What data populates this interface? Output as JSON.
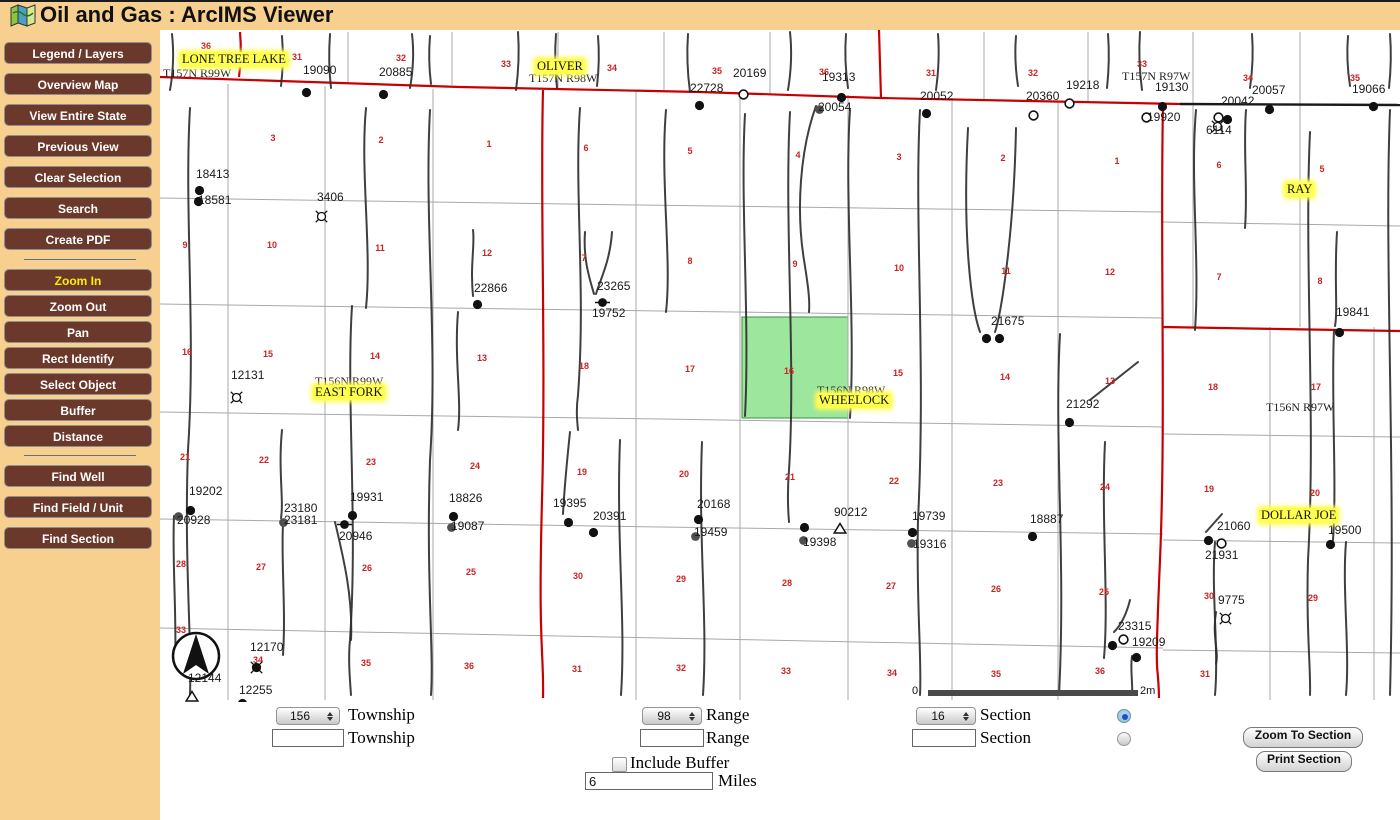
{
  "header": {
    "title": "Oil and Gas : ArcIMS Viewer"
  },
  "colors": {
    "header_bg": "#F7CF8E",
    "button_bg": "#6B392C",
    "button_text": "#FFFFFF",
    "active_tool_color": "#FFEB00",
    "boundary_red": "#C80000",
    "black_line": "#1A1A1A",
    "grid_gray": "#A8A8A8",
    "selected_section_green": "#9DE69D",
    "highlight_yellow": "#FFFF4F",
    "section_number_red": "#CC2222"
  },
  "sidebar": {
    "groups": [
      {
        "buttons": [
          {
            "label": "Legend / Layers"
          },
          {
            "label": "Overview Map"
          },
          {
            "label": "View Entire State"
          },
          {
            "label": "Previous View"
          },
          {
            "label": "Clear Selection"
          },
          {
            "label": "Search"
          },
          {
            "label": "Create PDF"
          }
        ]
      },
      {
        "buttons": [
          {
            "label": "Zoom In",
            "active": true
          },
          {
            "label": "Zoom Out"
          },
          {
            "label": "Pan"
          },
          {
            "label": "Rect Identify"
          },
          {
            "label": "Select Object"
          },
          {
            "label": "Buffer"
          },
          {
            "label": "Distance"
          }
        ]
      },
      {
        "buttons": [
          {
            "label": "Find Well"
          },
          {
            "label": "Find Field / Unit"
          },
          {
            "label": "Find Section"
          }
        ]
      }
    ]
  },
  "map": {
    "field_labels": [
      {
        "text": "LONE TREE LAKE",
        "x": 180,
        "y": 52
      },
      {
        "text": "OLIVER",
        "x": 535,
        "y": 59
      },
      {
        "text": "RAY",
        "x": 1285,
        "y": 182
      },
      {
        "text": "EAST FORK",
        "x": 313,
        "y": 385
      },
      {
        "text": "WHEELOCK",
        "x": 817,
        "y": 393
      },
      {
        "text": "DOLLAR JOE",
        "x": 1259,
        "y": 508
      }
    ],
    "township_labels": [
      {
        "text": "T157N R99W",
        "x": 163,
        "y": 66
      },
      {
        "text": "T157N R98W",
        "x": 529,
        "y": 71
      },
      {
        "text": "T157N R97W",
        "x": 1122,
        "y": 69
      },
      {
        "text": "T156N R99W",
        "x": 315,
        "y": 374
      },
      {
        "text": "T156N R98W",
        "x": 817,
        "y": 383
      },
      {
        "text": "T156N R97W",
        "x": 1266,
        "y": 400
      }
    ],
    "section_numbers": [
      [
        "36",
        206,
        46
      ],
      [
        "31",
        297,
        57
      ],
      [
        "32",
        401,
        58
      ],
      [
        "33",
        506,
        64
      ],
      [
        "34",
        612,
        68
      ],
      [
        "35",
        717,
        71
      ],
      [
        "36",
        824,
        72
      ],
      [
        "31",
        931,
        73
      ],
      [
        "32",
        1033,
        73
      ],
      [
        "33",
        1142,
        64
      ],
      [
        "34",
        1248,
        78
      ],
      [
        "35",
        1355,
        78
      ],
      [
        "3",
        273,
        138
      ],
      [
        "2",
        381,
        140
      ],
      [
        "1",
        489,
        144
      ],
      [
        "6",
        586,
        148
      ],
      [
        "5",
        690,
        151
      ],
      [
        "4",
        798,
        155
      ],
      [
        "3",
        899,
        157
      ],
      [
        "2",
        1003,
        158
      ],
      [
        "1",
        1117,
        161
      ],
      [
        "6",
        1219,
        165
      ],
      [
        "5",
        1322,
        169
      ],
      [
        "9",
        185,
        245
      ],
      [
        "10",
        272,
        245
      ],
      [
        "11",
        380,
        248
      ],
      [
        "12",
        487,
        253
      ],
      [
        "7",
        584,
        258
      ],
      [
        "8",
        690,
        261
      ],
      [
        "9",
        795,
        264
      ],
      [
        "10",
        899,
        268
      ],
      [
        "11",
        1006,
        271
      ],
      [
        "12",
        1110,
        272
      ],
      [
        "7",
        1219,
        277
      ],
      [
        "8",
        1320,
        281
      ],
      [
        "16",
        187,
        352
      ],
      [
        "15",
        268,
        354
      ],
      [
        "14",
        375,
        356
      ],
      [
        "13",
        482,
        358
      ],
      [
        "18",
        584,
        366
      ],
      [
        "17",
        690,
        369
      ],
      [
        "16",
        789,
        371
      ],
      [
        "15",
        898,
        373
      ],
      [
        "14",
        1005,
        377
      ],
      [
        "13",
        1110,
        381
      ],
      [
        "18",
        1213,
        387
      ],
      [
        "17",
        1316,
        387
      ],
      [
        "21",
        185,
        457
      ],
      [
        "22",
        264,
        460
      ],
      [
        "23",
        371,
        462
      ],
      [
        "24",
        475,
        466
      ],
      [
        "19",
        582,
        472
      ],
      [
        "20",
        684,
        474
      ],
      [
        "21",
        790,
        477
      ],
      [
        "22",
        894,
        481
      ],
      [
        "23",
        998,
        483
      ],
      [
        "24",
        1105,
        487
      ],
      [
        "19",
        1209,
        489
      ],
      [
        "20",
        1315,
        493
      ],
      [
        "28",
        181,
        564
      ],
      [
        "27",
        261,
        567
      ],
      [
        "26",
        367,
        568
      ],
      [
        "25",
        471,
        572
      ],
      [
        "30",
        578,
        576
      ],
      [
        "29",
        681,
        579
      ],
      [
        "28",
        787,
        583
      ],
      [
        "27",
        891,
        586
      ],
      [
        "26",
        996,
        589
      ],
      [
        "25",
        1104,
        592
      ],
      [
        "30",
        1209,
        596
      ],
      [
        "29",
        1313,
        598
      ],
      [
        "33",
        181,
        630
      ],
      [
        "34",
        258,
        660
      ],
      [
        "35",
        366,
        663
      ],
      [
        "36",
        469,
        666
      ],
      [
        "31",
        577,
        669
      ],
      [
        "32",
        681,
        668
      ],
      [
        "33",
        786,
        671
      ],
      [
        "34",
        892,
        673
      ],
      [
        "35",
        996,
        674
      ],
      [
        "36",
        1100,
        671
      ],
      [
        "31",
        1205,
        674
      ]
    ],
    "wells": [
      {
        "label": "19090",
        "lx": 303,
        "ly": 63,
        "sym": "dot",
        "sx": 301,
        "sy": 87
      },
      {
        "label": "20885",
        "lx": 379,
        "ly": 65,
        "sym": "dot",
        "sx": 378,
        "sy": 89
      },
      {
        "label": "20169",
        "lx": 733,
        "ly": 66,
        "sym": "none"
      },
      {
        "label": "22728",
        "lx": 690,
        "ly": 81,
        "sym": "open",
        "sx": 737,
        "sy": 88,
        "sym2": "dot",
        "s2x": 694,
        "s2y": 100
      },
      {
        "label": "19313",
        "lx": 822,
        "ly": 70,
        "sym": "dot",
        "sx": 836,
        "sy": 92
      },
      {
        "label": "20054",
        "lx": 818,
        "ly": 100,
        "sym": "graydot",
        "sx": 814,
        "sy": 104
      },
      {
        "label": "20052",
        "lx": 920,
        "ly": 89,
        "sym": "dot",
        "sx": 921,
        "sy": 108
      },
      {
        "label": "20360",
        "lx": 1026,
        "ly": 89,
        "sym": "open",
        "sx": 1063,
        "sy": 97,
        "sym2": "open",
        "s2x": 1027,
        "s2y": 109
      },
      {
        "label": "19218",
        "lx": 1066,
        "ly": 78,
        "sym": "none"
      },
      {
        "label": "19130",
        "lx": 1155,
        "ly": 80,
        "sym": "dot",
        "sx": 1157,
        "sy": 101
      },
      {
        "label": "19920",
        "lx": 1147,
        "ly": 110,
        "sym": "open",
        "sx": 1140,
        "sy": 111
      },
      {
        "label": "20042",
        "lx": 1221,
        "ly": 94,
        "sym": "open",
        "sx": 1212,
        "sy": 111,
        "sym2": "dot",
        "s2x": 1222,
        "s2y": 114
      },
      {
        "label": "6114",
        "lx": 1206,
        "ly": 123,
        "sym": "dryhole",
        "sx": 1208,
        "sy": 117
      },
      {
        "label": "20057",
        "lx": 1252,
        "ly": 83,
        "sym": "dot",
        "sx": 1264,
        "sy": 104
      },
      {
        "label": "19066",
        "lx": 1352,
        "ly": 82,
        "sym": "dot",
        "sx": 1368,
        "sy": 101
      },
      {
        "label": "18413",
        "lx": 196,
        "ly": 167,
        "sym": "dot",
        "sx": 194,
        "sy": 185
      },
      {
        "label": "18581",
        "lx": 198,
        "ly": 193,
        "sym": "dot",
        "sx": 193,
        "sy": 196
      },
      {
        "label": "3406",
        "lx": 317,
        "ly": 190,
        "sym": "dryhole",
        "sx": 312,
        "sy": 207
      },
      {
        "label": "22866",
        "lx": 474,
        "ly": 281,
        "sym": "dot",
        "sx": 472,
        "sy": 299
      },
      {
        "label": "23265",
        "lx": 597,
        "ly": 279,
        "sym": "dotbar",
        "sx": 594,
        "sy": 297
      },
      {
        "label": "19752",
        "lx": 592,
        "ly": 306,
        "sym": "none"
      },
      {
        "label": "21675",
        "lx": 991,
        "ly": 314,
        "sym": "dot",
        "sx": 981,
        "sy": 333,
        "sym2": "dot",
        "s2x": 994,
        "s2y": 333
      },
      {
        "label": "19841",
        "lx": 1336,
        "ly": 305,
        "sym": "dot",
        "sx": 1334,
        "sy": 327
      },
      {
        "label": "12131",
        "lx": 231,
        "ly": 368,
        "sym": "dryhole",
        "sx": 227,
        "sy": 388
      },
      {
        "label": "21292",
        "lx": 1066,
        "ly": 397,
        "sym": "dot",
        "sx": 1064,
        "sy": 417
      },
      {
        "label": "19202",
        "lx": 189,
        "ly": 484,
        "sym": "dot",
        "sx": 185,
        "sy": 505
      },
      {
        "label": "20928",
        "lx": 177,
        "ly": 513,
        "sym": "graydot",
        "sx": 173,
        "sy": 511
      },
      {
        "label": "23180",
        "lx": 284,
        "ly": 501,
        "sym": "none"
      },
      {
        "label": "23181",
        "lx": 284,
        "ly": 513,
        "sym": "graydot",
        "sx": 278,
        "sy": 517
      },
      {
        "label": "19931",
        "lx": 350,
        "ly": 490,
        "sym": "dot",
        "sx": 347,
        "sy": 510
      },
      {
        "label": "20946",
        "lx": 339,
        "ly": 529,
        "sym": "dotbar",
        "sx": 336,
        "sy": 519
      },
      {
        "label": "18826",
        "lx": 449,
        "ly": 491,
        "sym": "dot",
        "sx": 448,
        "sy": 511
      },
      {
        "label": "19087",
        "lx": 451,
        "ly": 519,
        "sym": "graydot",
        "sx": 446,
        "sy": 522
      },
      {
        "label": "19395",
        "lx": 553,
        "ly": 496,
        "sym": "dot",
        "sx": 563,
        "sy": 517
      },
      {
        "label": "20391",
        "lx": 593,
        "ly": 509,
        "sym": "dot",
        "sx": 588,
        "sy": 527
      },
      {
        "label": "20168",
        "lx": 697,
        "ly": 497,
        "sym": "dot",
        "sx": 693,
        "sy": 514
      },
      {
        "label": "19459",
        "lx": 694,
        "ly": 525,
        "sym": "graydot",
        "sx": 690,
        "sy": 531
      },
      {
        "label": "19398",
        "lx": 803,
        "ly": 535,
        "sym": "dot",
        "sx": 799,
        "sy": 522,
        "sym2": "graydot",
        "s2x": 798,
        "s2y": 535
      },
      {
        "label": "90212",
        "lx": 834,
        "ly": 505,
        "sym": "triangle",
        "sx": 833,
        "sy": 522
      },
      {
        "label": "19739",
        "lx": 912,
        "ly": 509,
        "sym": "dot",
        "sx": 907,
        "sy": 527
      },
      {
        "label": "19316",
        "lx": 913,
        "ly": 537,
        "sym": "graydot",
        "sx": 906,
        "sy": 538
      },
      {
        "label": "18887",
        "lx": 1030,
        "ly": 512,
        "sym": "dot",
        "sx": 1027,
        "sy": 531
      },
      {
        "label": "21060",
        "lx": 1217,
        "ly": 519,
        "sym": "dot",
        "sx": 1203,
        "sy": 535,
        "sym2": "open",
        "s2x": 1215,
        "s2y": 537
      },
      {
        "label": "21931",
        "lx": 1205,
        "ly": 548,
        "sym": "none"
      },
      {
        "label": "19500",
        "lx": 1328,
        "ly": 523,
        "sym": "dot",
        "sx": 1325,
        "sy": 539
      },
      {
        "label": "9775",
        "lx": 1218,
        "ly": 593,
        "sym": "dryhole",
        "sx": 1216,
        "sy": 609
      },
      {
        "label": "23315",
        "lx": 1118,
        "ly": 619,
        "sym": "open",
        "sx": 1117,
        "sy": 633,
        "sym2": "dot",
        "s2x": 1107,
        "s2y": 640
      },
      {
        "label": "19209",
        "lx": 1132,
        "ly": 635,
        "sym": "dot",
        "sx": 1131,
        "sy": 652
      },
      {
        "label": "12170",
        "lx": 250,
        "ly": 640,
        "sym": "spokedot",
        "sx": 247,
        "sy": 658
      },
      {
        "label": "12144",
        "lx": 188,
        "ly": 671,
        "sym": "triangle",
        "sx": 185,
        "sy": 690
      },
      {
        "label": "12255",
        "lx": 239,
        "ly": 683,
        "sym": "dot",
        "sx": 237,
        "sy": 698
      }
    ],
    "scale_bar": {
      "left_label": "0",
      "right_label": "2m"
    }
  },
  "form": {
    "township": {
      "select_value": "156",
      "label": "Township",
      "input_value": ""
    },
    "range": {
      "select_value": "98",
      "label": "Range",
      "input_value": ""
    },
    "section": {
      "select_value": "16",
      "label": "Section",
      "input_value": ""
    },
    "include_buffer_label": "Include Buffer",
    "miles": {
      "value": "6",
      "label": "Miles"
    },
    "buttons": {
      "zoom_to_section": "Zoom To Section",
      "print_section": "Print Section"
    }
  }
}
